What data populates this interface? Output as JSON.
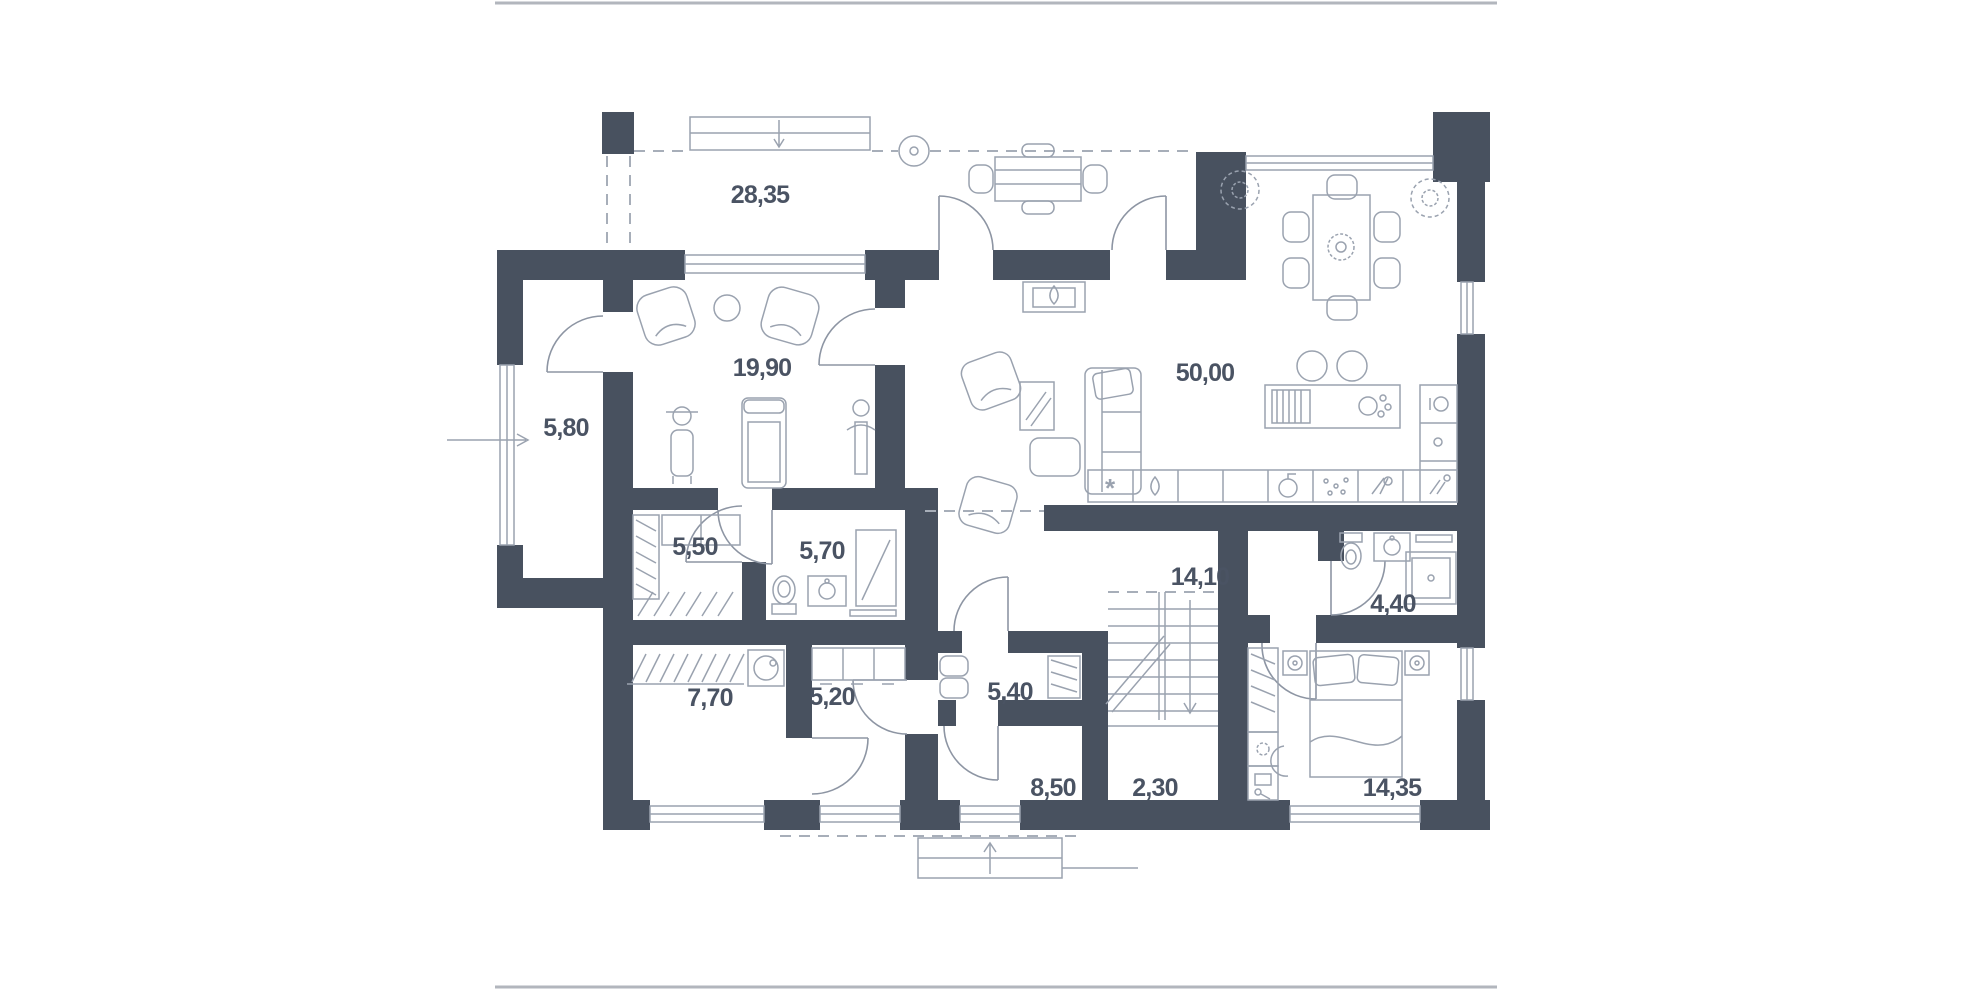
{
  "title": "floor-plan",
  "frame": {
    "color": "#b2b6bd"
  },
  "plan": {
    "wall_color": "#48515f",
    "furniture_line_color": "#9aa2af",
    "dash_color": "#a7aeb9",
    "label_color": "#4a5363",
    "background": "#ffffff"
  },
  "rooms": {
    "terrace": {
      "area": "28,35"
    },
    "gym": {
      "area": "19,90"
    },
    "porch": {
      "area": "5,80"
    },
    "living_kitchen": {
      "area": "50,00"
    },
    "dressing": {
      "area": "5,50"
    },
    "bathroom": {
      "area": "5,70"
    },
    "corridor": {
      "area": "14,10"
    },
    "wc": {
      "area": "4,40"
    },
    "storage": {
      "area": "7,70"
    },
    "laundry": {
      "area": "5,20"
    },
    "hall": {
      "area": "5,40"
    },
    "entry_hall": {
      "area": "8,50"
    },
    "stairwell": {
      "area": "2,30"
    },
    "bedroom": {
      "area": "14,35"
    }
  },
  "icons": {
    "freezer_glyph": "*"
  }
}
